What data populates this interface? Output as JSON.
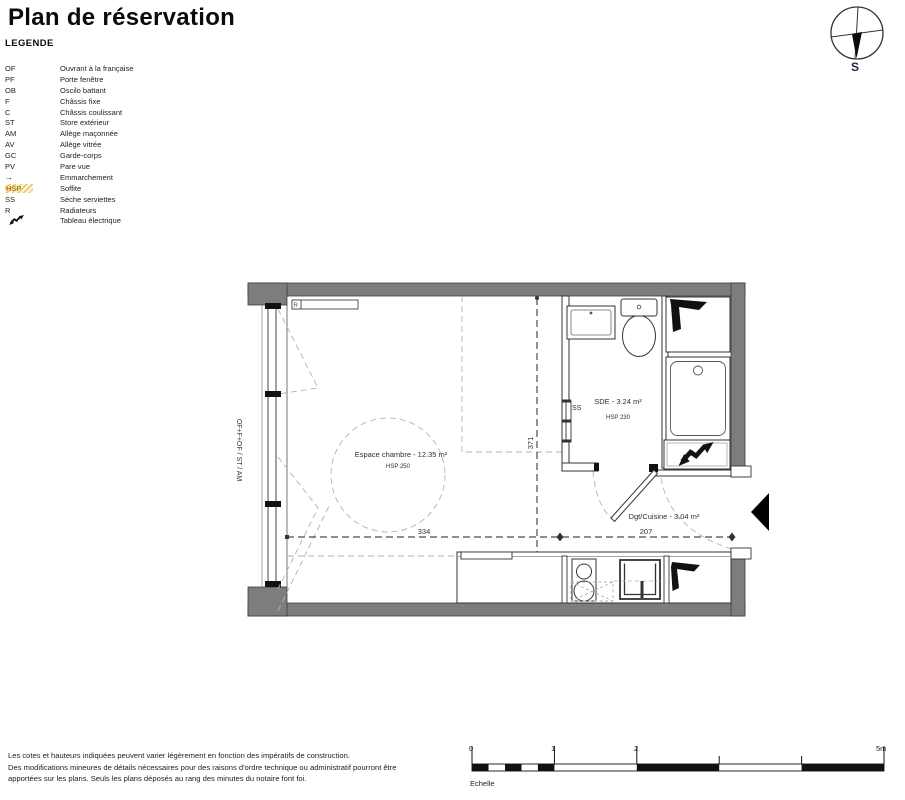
{
  "title": "Plan de réservation",
  "legend": {
    "heading": "LEGENDE",
    "items": [
      {
        "abbr": "OF",
        "desc": "Ouvrant à la française"
      },
      {
        "abbr": "PF",
        "desc": "Porte fenêtre"
      },
      {
        "abbr": "OB",
        "desc": "Oscilo battant"
      },
      {
        "abbr": "F",
        "desc": "Châssis fixe"
      },
      {
        "abbr": "C",
        "desc": "Châssis coulissant"
      },
      {
        "abbr": "ST",
        "desc": "Store extérieur"
      },
      {
        "abbr": "AM",
        "desc": "Allège maçonnée"
      },
      {
        "abbr": "AV",
        "desc": "Allège vitrée"
      },
      {
        "abbr": "GC",
        "desc": "Garde-corps"
      },
      {
        "abbr": "PV",
        "desc": "Pare vue"
      },
      {
        "abbr": "→",
        "desc": "Emmarchement",
        "icon": "arrow-right-icon"
      },
      {
        "abbr": "HSP",
        "desc": "Soffite",
        "icon": "hatch-swatch"
      },
      {
        "abbr": "SS",
        "desc": "Sèche serviettes"
      },
      {
        "abbr": "R",
        "desc": "Radiateurs"
      },
      {
        "abbr": "",
        "desc": "Tableau électrique",
        "icon": "lightning-icon"
      }
    ]
  },
  "compass": {
    "south_label": "S"
  },
  "plan": {
    "window_label": "OF+F+OF / ST / AM",
    "radiator_label": "R",
    "rooms": {
      "chambre": {
        "name": "Espace chambre - 12.35 m²",
        "hsp": "HSP 250"
      },
      "sde": {
        "name": "SDE - 3.24 m²",
        "hsp": "HSP 230",
        "ss_label": "SS"
      },
      "cuisine": {
        "name": "Dgt/Cuisine - 3.04 m²"
      }
    },
    "dimensions": {
      "width_left": "334",
      "width_right": "207",
      "height": "371"
    }
  },
  "footer": {
    "disclaimer_lines": [
      "Les cotes et hauteurs indiquées peuvent varier légèrement en fonction des impératifs de construction.",
      "Des modifications mineures de détails nécessaires pour des raisons d'ordre technique ou administratif pourront être",
      "apportées sur les plans. Seuls les plans déposés au rang des minutes du notaire font foi."
    ],
    "scale": {
      "label": "Echelle",
      "ticks": [
        "0",
        "1",
        "2",
        "5m"
      ]
    }
  },
  "colors": {
    "wall_gray": "#7d7d7d",
    "hsp_accent": "#b97b10",
    "line_dark": "#333333"
  }
}
